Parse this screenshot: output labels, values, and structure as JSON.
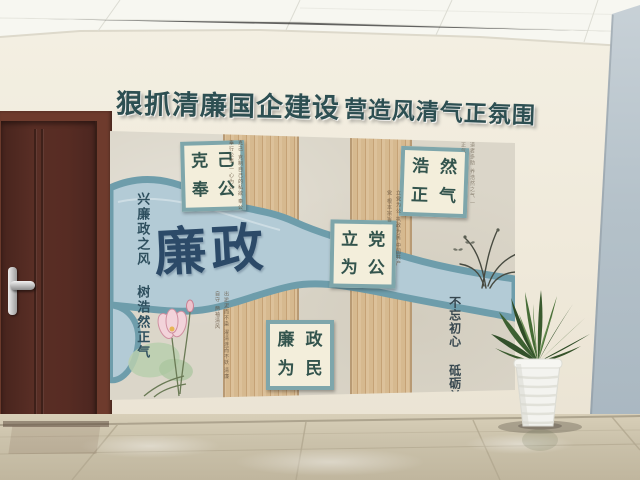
{
  "banner": {
    "segment1": "狠抓清廉国企建设",
    "segment2": "营造风清气正氛围"
  },
  "display_wall": {
    "headline": "廉政",
    "left_slogan": {
      "column_right": "兴廉政之风",
      "column_left": "树浩然正气"
    },
    "right_slogan": {
      "column_right": "不忘初心",
      "column_left": "砥砺前行"
    },
    "plaques": [
      {
        "name": "ke-ji-feng-gong",
        "top_left": "克",
        "top_right": "己",
        "bottom_left": "奉",
        "bottom_right": "公"
      },
      {
        "name": "hao-ran-zheng-qi",
        "top_left": "浩",
        "top_right": "然",
        "bottom_left": "正",
        "bottom_right": "气"
      },
      {
        "name": "li-dang-wei-gong",
        "top_left": "立",
        "top_right": "党",
        "bottom_left": "为",
        "bottom_right": "公"
      },
      {
        "name": "lian-zheng-wei-min",
        "top_left": "廉",
        "top_right": "政",
        "bottom_left": "为",
        "bottom_right": "民"
      }
    ],
    "fine_print": {
      "note1": "克己 克制自己的私欲 奉公 奉行公事 一心为公",
      "note2": "得道者多助 养浩然之气 一身正气",
      "note3": "立党为公 执政为民 中国共产党 根本宗旨",
      "note4": "出淤泥而不染 濯清涟而不妖 清廉自守 两袖清风"
    }
  },
  "colors": {
    "banner_text": "#2d4f52",
    "wall": "#efe9da",
    "door": "#542a21",
    "right_wall": "#b4c1c9",
    "river": "#b3cbd6",
    "river_edge": "#6e9dab",
    "plaque_border": "#7ea6ab",
    "plaque_background": "#f3eedb",
    "plaque_text": "#33544d",
    "headline_text": "#2c4a68",
    "wood_panel": "#d6b98f",
    "stone_panel": "#dbd6c9",
    "floor": "#cbc2ab",
    "plant_leaf": "#3d5c31",
    "pot": "#f2f2ee"
  }
}
